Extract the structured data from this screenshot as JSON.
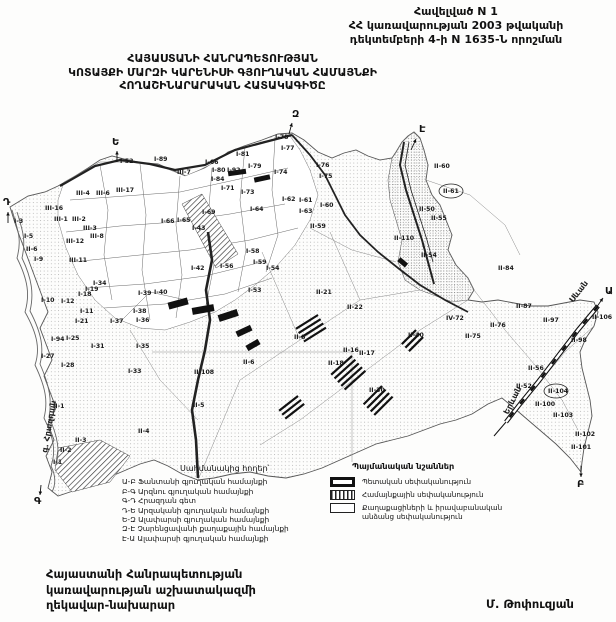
{
  "header": {
    "l1": "Հավելված N 1",
    "l2": "ՀՀ կառավարության 2003 թվականի",
    "l3": "դեկտեմբերի 4-ի N 1635-Ն որոշման"
  },
  "title": {
    "l1": "ՀԱՅԱՍՏԱՆԻ ՀԱՆՐԱՊԵՏՈՒԹՅԱՆ",
    "l2": "ԿՈՏԱՅՔԻ ՄԱՐԶԻ ԿԱՐԵՆԻՍԻ ԳՅՈՒՂԱԿԱՆ ՀԱՄԱՅՆՔԻ",
    "l3": "ՀՈՂԱՇԻՆԱՐԱՐԱԿԱՆ ՀԱՏԱԿԱԳԻԾԸ"
  },
  "adjacent_lands": {
    "title": "Սահմանակից հողեր՝",
    "items": [
      "Ա-Բ Ֆանտանի գյուղական համայնքի",
      "Բ-Գ Արզնու գյուղական համայնքի",
      "Գ-Դ Հրազդան գետ",
      "Դ-Ե Արզականի գյուղական համայնքի",
      "Ե-Զ Ալափարսի գյուղական համայնքի",
      "Զ-Է Չարենցավանի քաղաքային համայնքի",
      "Է-Ա Ալափարսի գյուղական համայնքի"
    ]
  },
  "legend": {
    "title": "Պայմանական նշաններ",
    "items": [
      {
        "swatch": "state",
        "label": "Պետական սեփականություն"
      },
      {
        "swatch": "community",
        "label": "Համայնքային սեփականություն"
      },
      {
        "swatch": "private",
        "label": "Քաղաքացիների և իրավաբանական անձանց սեփականություն"
      }
    ]
  },
  "footer": {
    "left_lines": [
      "Հայաստանի Հանրապետության",
      "կառավարության աշխատակազմի",
      "ղեկավար-նախարար"
    ],
    "right": "Մ. Թոփուզյան"
  },
  "map": {
    "boundary_letters": [
      {
        "t": "Ա",
        "x": 605,
        "y": 294,
        "ax1": 596,
        "ay1": 308,
        "ax2": 603,
        "ay2": 298
      },
      {
        "t": "Բ",
        "x": 577,
        "y": 487,
        "ax1": 581,
        "ay1": 466,
        "ax2": 581,
        "ay2": 477
      },
      {
        "t": "Գ",
        "x": 34,
        "y": 504,
        "ax1": 41,
        "ay1": 485,
        "ax2": 40,
        "ay2": 495
      },
      {
        "t": "Դ",
        "x": 3,
        "y": 205,
        "ax1": 8,
        "ay1": 223,
        "ax2": 8,
        "ay2": 212
      },
      {
        "t": "Ե",
        "x": 112,
        "y": 145,
        "ax1": 117,
        "ay1": 162,
        "ax2": 117,
        "ay2": 151
      },
      {
        "t": "Զ",
        "x": 292,
        "y": 117,
        "ax1": 289,
        "ay1": 134,
        "ax2": 292,
        "ay2": 123
      },
      {
        "t": "Է",
        "x": 419,
        "y": 132,
        "ax1": 411,
        "ay1": 150,
        "ax2": 416,
        "ay2": 139
      }
    ],
    "road_labels": [
      {
        "t": "Սևան",
        "x": 573,
        "y": 303,
        "r": -52
      },
      {
        "t": "Երևան",
        "x": 508,
        "y": 415,
        "r": -63
      },
      {
        "t": "գ. Հրազդան",
        "x": 47,
        "y": 453,
        "r": -80
      }
    ],
    "parcel_labels": [
      {
        "t": "I-52",
        "x": 120,
        "y": 163
      },
      {
        "t": "I-89",
        "x": 154,
        "y": 161
      },
      {
        "t": "III-7",
        "x": 177,
        "y": 174
      },
      {
        "t": "III-17",
        "x": 116,
        "y": 192
      },
      {
        "t": "III-16",
        "x": 45,
        "y": 210
      },
      {
        "t": "III-4",
        "x": 76,
        "y": 195
      },
      {
        "t": "III-6",
        "x": 96,
        "y": 195
      },
      {
        "t": "III-1",
        "x": 54,
        "y": 221
      },
      {
        "t": "III-2",
        "x": 72,
        "y": 221
      },
      {
        "t": "III-3",
        "x": 83,
        "y": 230
      },
      {
        "t": "III-12",
        "x": 66,
        "y": 243
      },
      {
        "t": "III-8",
        "x": 90,
        "y": 238
      },
      {
        "t": "III-11",
        "x": 69,
        "y": 262
      },
      {
        "t": "I-3",
        "x": 14,
        "y": 223
      },
      {
        "t": "I-5",
        "x": 24,
        "y": 238
      },
      {
        "t": "II-6",
        "x": 26,
        "y": 251
      },
      {
        "t": "I-9",
        "x": 34,
        "y": 261
      },
      {
        "t": "I-66",
        "x": 161,
        "y": 223
      },
      {
        "t": "I-65",
        "x": 177,
        "y": 222
      },
      {
        "t": "I-43",
        "x": 192,
        "y": 230
      },
      {
        "t": "I-42",
        "x": 191,
        "y": 270
      },
      {
        "t": "I-66",
        "x": 205,
        "y": 164
      },
      {
        "t": "I-80",
        "x": 212,
        "y": 172
      },
      {
        "t": "I-92",
        "x": 227,
        "y": 172
      },
      {
        "t": "I-84",
        "x": 211,
        "y": 181
      },
      {
        "t": "I-81",
        "x": 236,
        "y": 156
      },
      {
        "t": "I-79",
        "x": 248,
        "y": 168
      },
      {
        "t": "I-74",
        "x": 274,
        "y": 174
      },
      {
        "t": "I-78",
        "x": 275,
        "y": 139
      },
      {
        "t": "I-77",
        "x": 281,
        "y": 150
      },
      {
        "t": "I-76",
        "x": 316,
        "y": 167
      },
      {
        "t": "I-75",
        "x": 319,
        "y": 178
      },
      {
        "t": "I-71",
        "x": 221,
        "y": 190
      },
      {
        "t": "I-73",
        "x": 241,
        "y": 194
      },
      {
        "t": "I-62",
        "x": 282,
        "y": 201
      },
      {
        "t": "I-61",
        "x": 299,
        "y": 202
      },
      {
        "t": "I-60",
        "x": 320,
        "y": 207
      },
      {
        "t": "I-63",
        "x": 299,
        "y": 213
      },
      {
        "t": "I-64",
        "x": 250,
        "y": 211
      },
      {
        "t": "I-69",
        "x": 202,
        "y": 214
      },
      {
        "t": "II-59",
        "x": 310,
        "y": 228
      },
      {
        "t": "I-58",
        "x": 246,
        "y": 253
      },
      {
        "t": "I-59",
        "x": 253,
        "y": 264
      },
      {
        "t": "I-54",
        "x": 266,
        "y": 270
      },
      {
        "t": "I-56",
        "x": 220,
        "y": 268
      },
      {
        "t": "I-53",
        "x": 248,
        "y": 292
      },
      {
        "t": "I-39",
        "x": 138,
        "y": 295
      },
      {
        "t": "I-40",
        "x": 154,
        "y": 294
      },
      {
        "t": "I-38",
        "x": 133,
        "y": 313
      },
      {
        "t": "I-36",
        "x": 136,
        "y": 322
      },
      {
        "t": "I-37",
        "x": 110,
        "y": 323
      },
      {
        "t": "I-34",
        "x": 93,
        "y": 285
      },
      {
        "t": "I-19",
        "x": 85,
        "y": 291
      },
      {
        "t": "I-18",
        "x": 78,
        "y": 296
      },
      {
        "t": "I-10",
        "x": 41,
        "y": 302
      },
      {
        "t": "I-12",
        "x": 61,
        "y": 303
      },
      {
        "t": "I-11",
        "x": 80,
        "y": 313
      },
      {
        "t": "I-21",
        "x": 75,
        "y": 323
      },
      {
        "t": "I-94",
        "x": 51,
        "y": 341
      },
      {
        "t": "I-25",
        "x": 66,
        "y": 340
      },
      {
        "t": "I-27",
        "x": 41,
        "y": 358
      },
      {
        "t": "I-28",
        "x": 61,
        "y": 367
      },
      {
        "t": "I-31",
        "x": 91,
        "y": 348
      },
      {
        "t": "I-35",
        "x": 136,
        "y": 348
      },
      {
        "t": "I-33",
        "x": 128,
        "y": 373
      },
      {
        "t": "II-1",
        "x": 53,
        "y": 408
      },
      {
        "t": "II-3",
        "x": 75,
        "y": 442
      },
      {
        "t": "II-2",
        "x": 60,
        "y": 452
      },
      {
        "t": "I-1",
        "x": 53,
        "y": 464
      },
      {
        "t": "II-4",
        "x": 138,
        "y": 433
      },
      {
        "t": "II-108",
        "x": 194,
        "y": 374
      },
      {
        "t": "II-5",
        "x": 193,
        "y": 407
      },
      {
        "t": "II-6",
        "x": 243,
        "y": 364
      },
      {
        "t": "II-8",
        "x": 294,
        "y": 339
      },
      {
        "t": "II-21",
        "x": 316,
        "y": 294
      },
      {
        "t": "II-22",
        "x": 347,
        "y": 309
      },
      {
        "t": "II-16",
        "x": 343,
        "y": 352
      },
      {
        "t": "II-17",
        "x": 359,
        "y": 355
      },
      {
        "t": "II-18",
        "x": 328,
        "y": 365
      },
      {
        "t": "II-30",
        "x": 369,
        "y": 392
      },
      {
        "t": "II-110",
        "x": 394,
        "y": 240
      },
      {
        "t": "II-54",
        "x": 421,
        "y": 257
      },
      {
        "t": "II-50",
        "x": 419,
        "y": 211
      },
      {
        "t": "II-55",
        "x": 431,
        "y": 220
      },
      {
        "t": "II-60",
        "x": 434,
        "y": 168
      },
      {
        "t": "II-61",
        "x": 443,
        "y": 193,
        "circled": true
      },
      {
        "t": "II-40",
        "x": 408,
        "y": 337
      },
      {
        "t": "II-84",
        "x": 498,
        "y": 270
      },
      {
        "t": "IV-72",
        "x": 446,
        "y": 320
      },
      {
        "t": "II-76",
        "x": 490,
        "y": 327
      },
      {
        "t": "II-75",
        "x": 465,
        "y": 338
      },
      {
        "t": "II-87",
        "x": 516,
        "y": 308
      },
      {
        "t": "II-97",
        "x": 543,
        "y": 322
      },
      {
        "t": "II-98",
        "x": 571,
        "y": 342
      },
      {
        "t": "II-106",
        "x": 592,
        "y": 319
      },
      {
        "t": "II-56",
        "x": 528,
        "y": 370
      },
      {
        "t": "II-52",
        "x": 516,
        "y": 388
      },
      {
        "t": "II-104",
        "x": 548,
        "y": 393,
        "circled": true
      },
      {
        "t": "II-100",
        "x": 535,
        "y": 406
      },
      {
        "t": "II-103",
        "x": 553,
        "y": 417
      },
      {
        "t": "II-102",
        "x": 575,
        "y": 436
      },
      {
        "t": "II-101",
        "x": 571,
        "y": 449
      }
    ]
  }
}
